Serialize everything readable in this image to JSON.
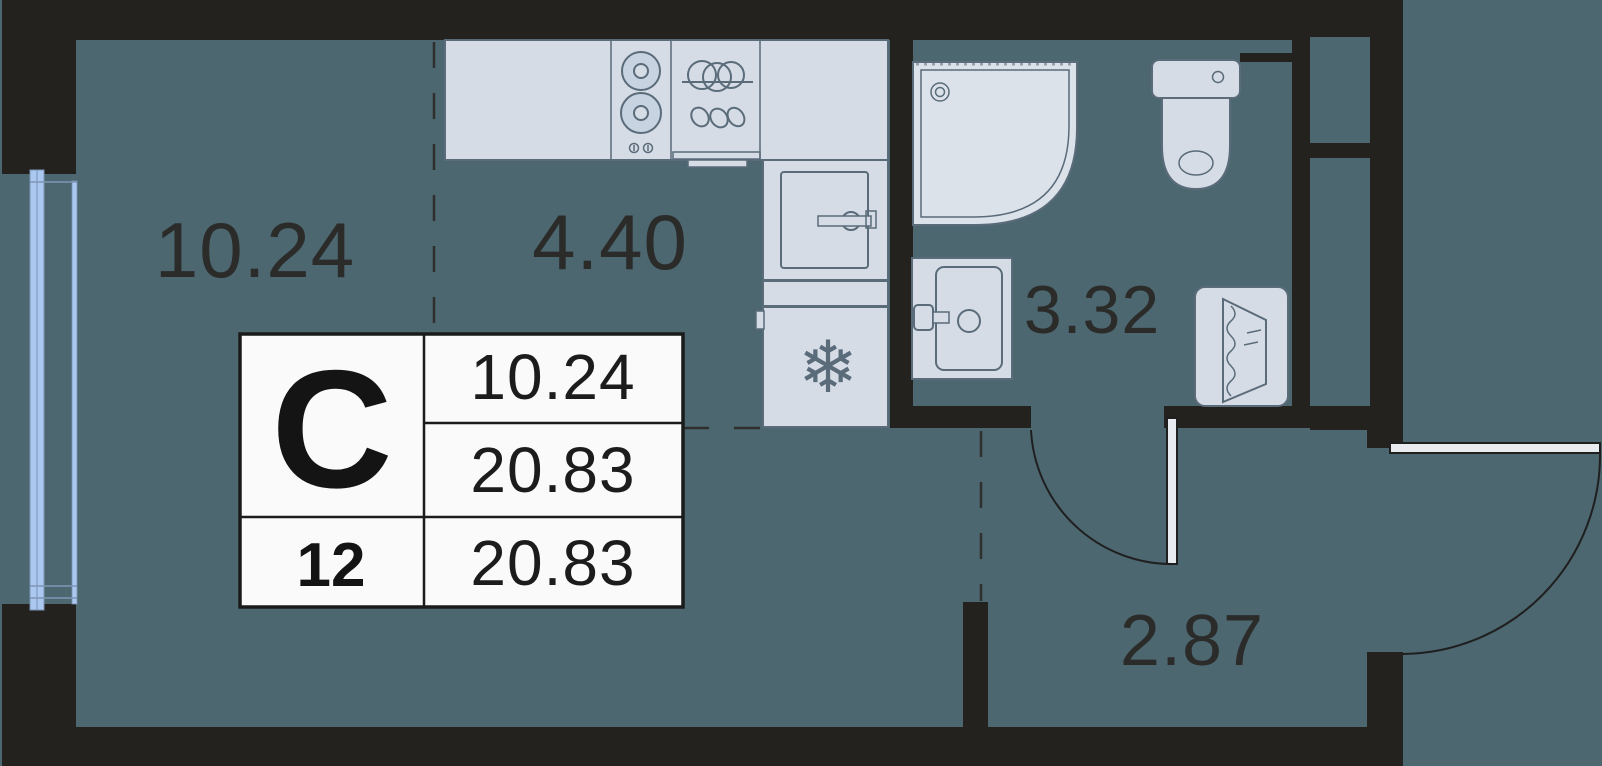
{
  "plan": {
    "title": "studio-apartment-floor-plan",
    "room_labels": {
      "living": "10.24",
      "kitchen": "4.40",
      "bathroom": "3.32",
      "hallway": "2.87"
    },
    "info_table": {
      "unit_type": "С",
      "living_area": "10.24",
      "total_area": "20.83",
      "floor": "12",
      "total_area_bottom": "20.83"
    },
    "icons": [
      "stove-burners-icon",
      "kitchen-sink-dishes-icon",
      "oven-icon",
      "fridge-snowflake-icon",
      "shower-tray-icon",
      "toilet-icon",
      "washbasin-icon",
      "washing-machine-icon",
      "window-icon",
      "door-swing-icon"
    ],
    "snowflake_glyph": "❄",
    "colors": {
      "floor": "#4C6770",
      "wall": "#23221F",
      "fixture_fill": "#D5DCE5",
      "fixture_stroke": "#5A6B7A",
      "window_blue": "#ABC8F1",
      "table_bg": "#FAFAFA",
      "label_text": "#2B2B29"
    }
  }
}
